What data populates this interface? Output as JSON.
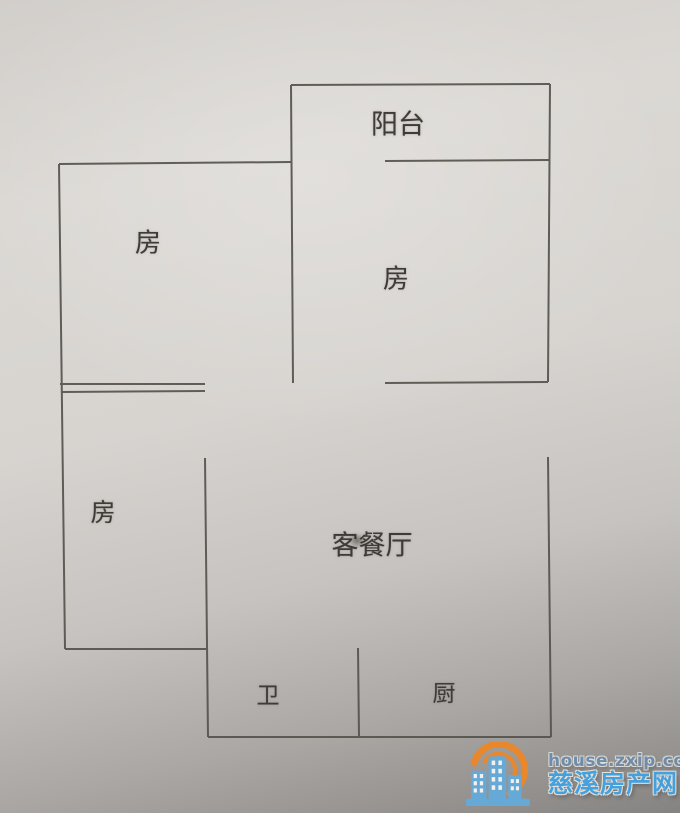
{
  "floor_plan": {
    "wall_color": "#56524c",
    "labels": {
      "balcony": "阳台",
      "bedroom_top_left": "房",
      "bedroom_top_right": "房",
      "bedroom_lower_left": "房",
      "living_dining": "客餐厅",
      "bathroom": "卫",
      "kitchen": "厨"
    }
  },
  "watermark": {
    "site_url": "house.zxip.com",
    "site_name": "慈溪房产网",
    "logo_icon": "city-buildings-sun-icon",
    "colors": {
      "url_text": "#6f8cab",
      "name_text": "#45a0dc",
      "buildings": "#66a9d6",
      "sun_arc": "#e8872c"
    }
  }
}
